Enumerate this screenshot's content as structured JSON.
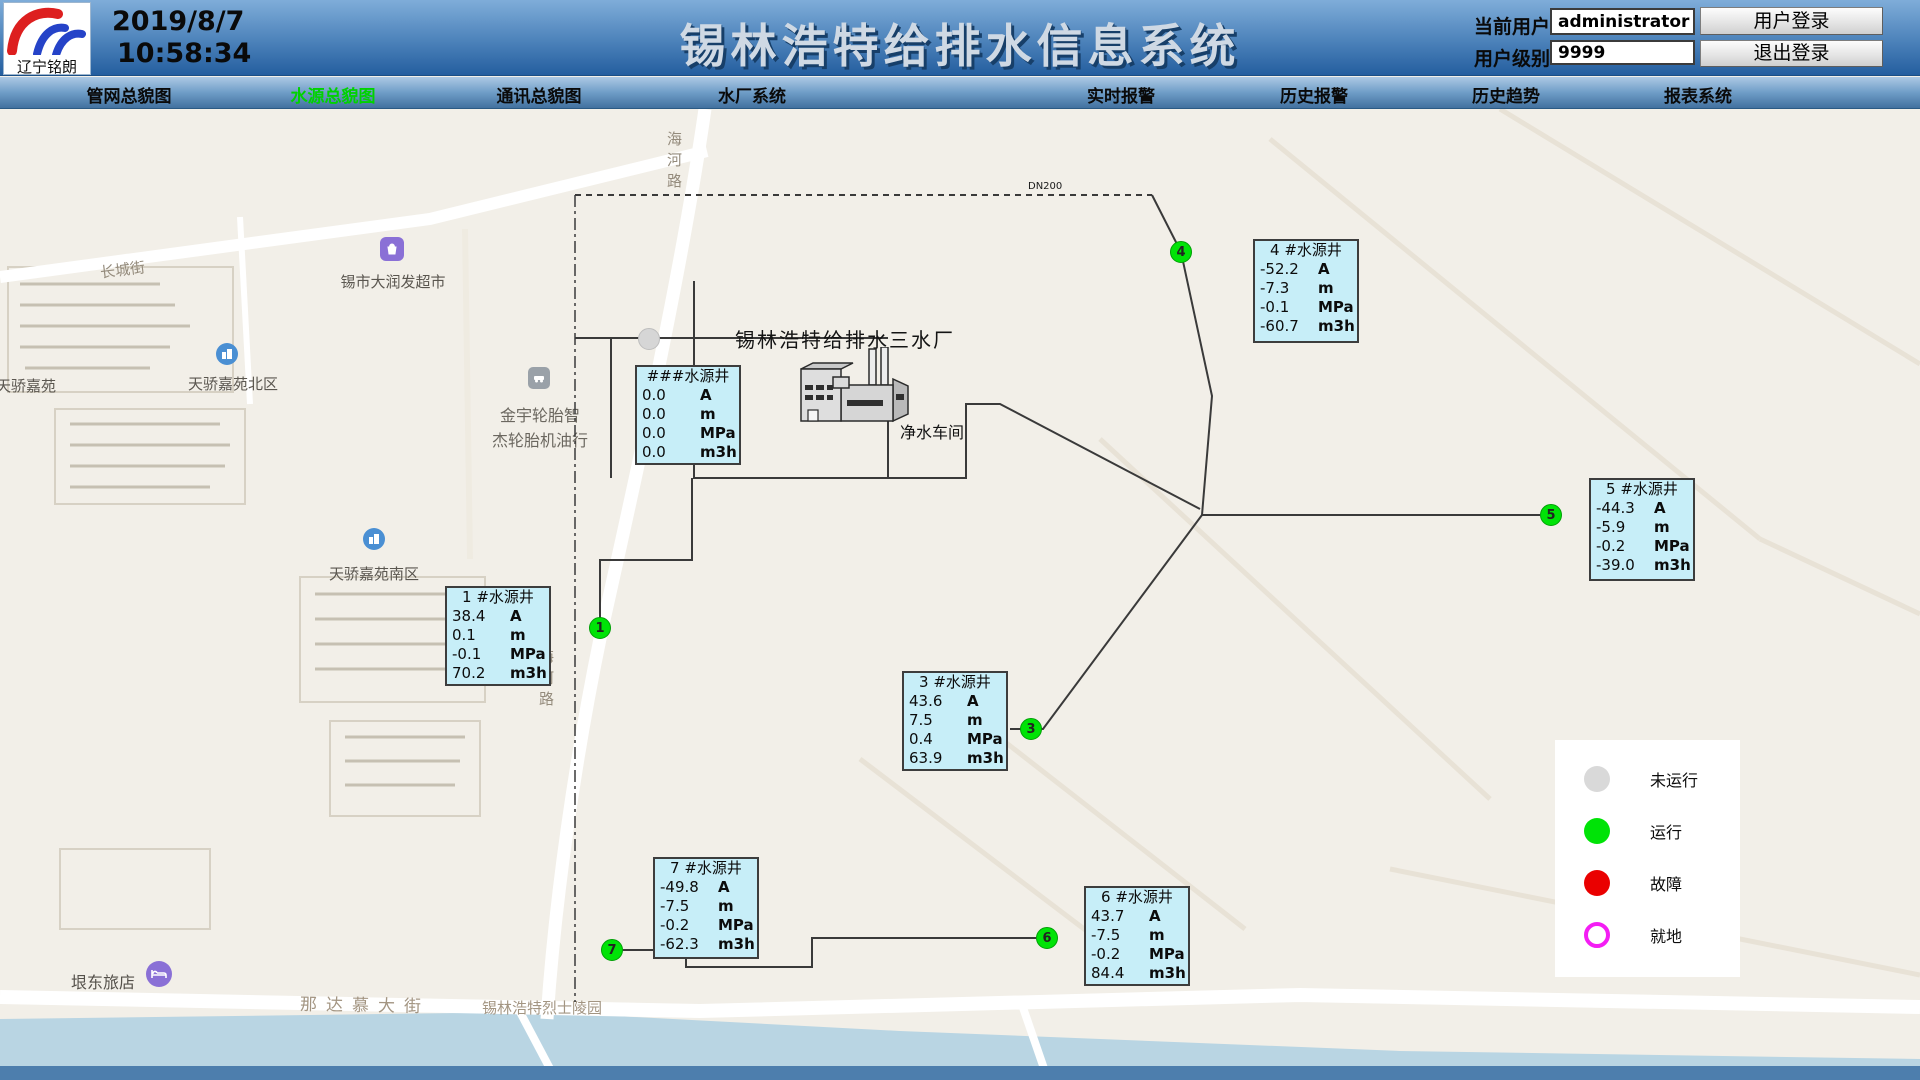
{
  "header": {
    "logo_text": "辽宁铭朗",
    "date": "2019/8/7",
    "time": "10:58:34",
    "title": "锡林浩特给排水信息系统",
    "current_user_label": "当前用户",
    "current_user_value": "administrator",
    "user_level_label": "用户级别",
    "user_level_value": "9999",
    "login_button": "用户登录",
    "logout_button": "退出登录"
  },
  "nav": {
    "active_color": "#00d200",
    "items": [
      {
        "label": "管网总貌图",
        "active": false
      },
      {
        "label": "水源总貌图",
        "active": true
      },
      {
        "label": "通讯总貌图",
        "active": false
      },
      {
        "label": "水厂系统",
        "active": false
      },
      {
        "label": "实时报警",
        "active": false
      },
      {
        "label": "历史报警",
        "active": false
      },
      {
        "label": "历史趋势",
        "active": false
      },
      {
        "label": "报表系统",
        "active": false
      }
    ]
  },
  "map_labels": {
    "changcheng_street": "长城街",
    "supermarket": "锡市大润发超市",
    "tianjiao": "天骄嘉苑",
    "tianjiao_north": "天骄嘉苑北区",
    "tianjiao_south": "天骄嘉苑南区",
    "jinyu_line1": "金宇轮胎智",
    "jinyu_line2": "杰轮胎机油行",
    "haihe_road": "海河路",
    "hotel": "垠东旅店",
    "nadamu_street": "那达慕大街",
    "martyrs_cemetery": "锡林浩特烈士陵园",
    "dn200": "DN200"
  },
  "plant": {
    "title": "锡林浩特给排水三水厂",
    "workshop": "净水车间"
  },
  "units": {
    "current": "A",
    "level": "m",
    "pressure": "MPa",
    "flow": "m3h"
  },
  "wells": {
    "unknown": {
      "title": "###水源井",
      "current": "0.0",
      "level": "0.0",
      "pressure": "0.0",
      "flow": "0.0"
    },
    "w1": {
      "num": "1",
      "title": "1 #水源井",
      "current": "38.4",
      "level": "0.1",
      "pressure": "-0.1",
      "flow": "70.2"
    },
    "w3": {
      "num": "3",
      "title": "3 #水源井",
      "current": "43.6",
      "level": "7.5",
      "pressure": "0.4",
      "flow": "63.9"
    },
    "w4": {
      "num": "4",
      "title": "4 #水源井",
      "current": "-52.2",
      "level": "-7.3",
      "pressure": "-0.1",
      "flow": "-60.7"
    },
    "w5": {
      "num": "5",
      "title": "5 #水源井",
      "current": "-44.3",
      "level": "-5.9",
      "pressure": "-0.2",
      "flow": "-39.0"
    },
    "w6": {
      "num": "6",
      "title": "6 #水源井",
      "current": "43.7",
      "level": "-7.5",
      "pressure": "-0.2",
      "flow": "84.4"
    },
    "w7": {
      "num": "7",
      "title": "7 #水源井",
      "current": "-49.8",
      "level": "-7.5",
      "pressure": "-0.2",
      "flow": "-62.3"
    }
  },
  "legend": {
    "items": [
      {
        "label": "未运行",
        "color": "#d9d9d9"
      },
      {
        "label": "运行",
        "color": "#00e307"
      },
      {
        "label": "故障",
        "color": "#ea0000"
      },
      {
        "label": "就地",
        "color": "#f41df4"
      }
    ]
  }
}
